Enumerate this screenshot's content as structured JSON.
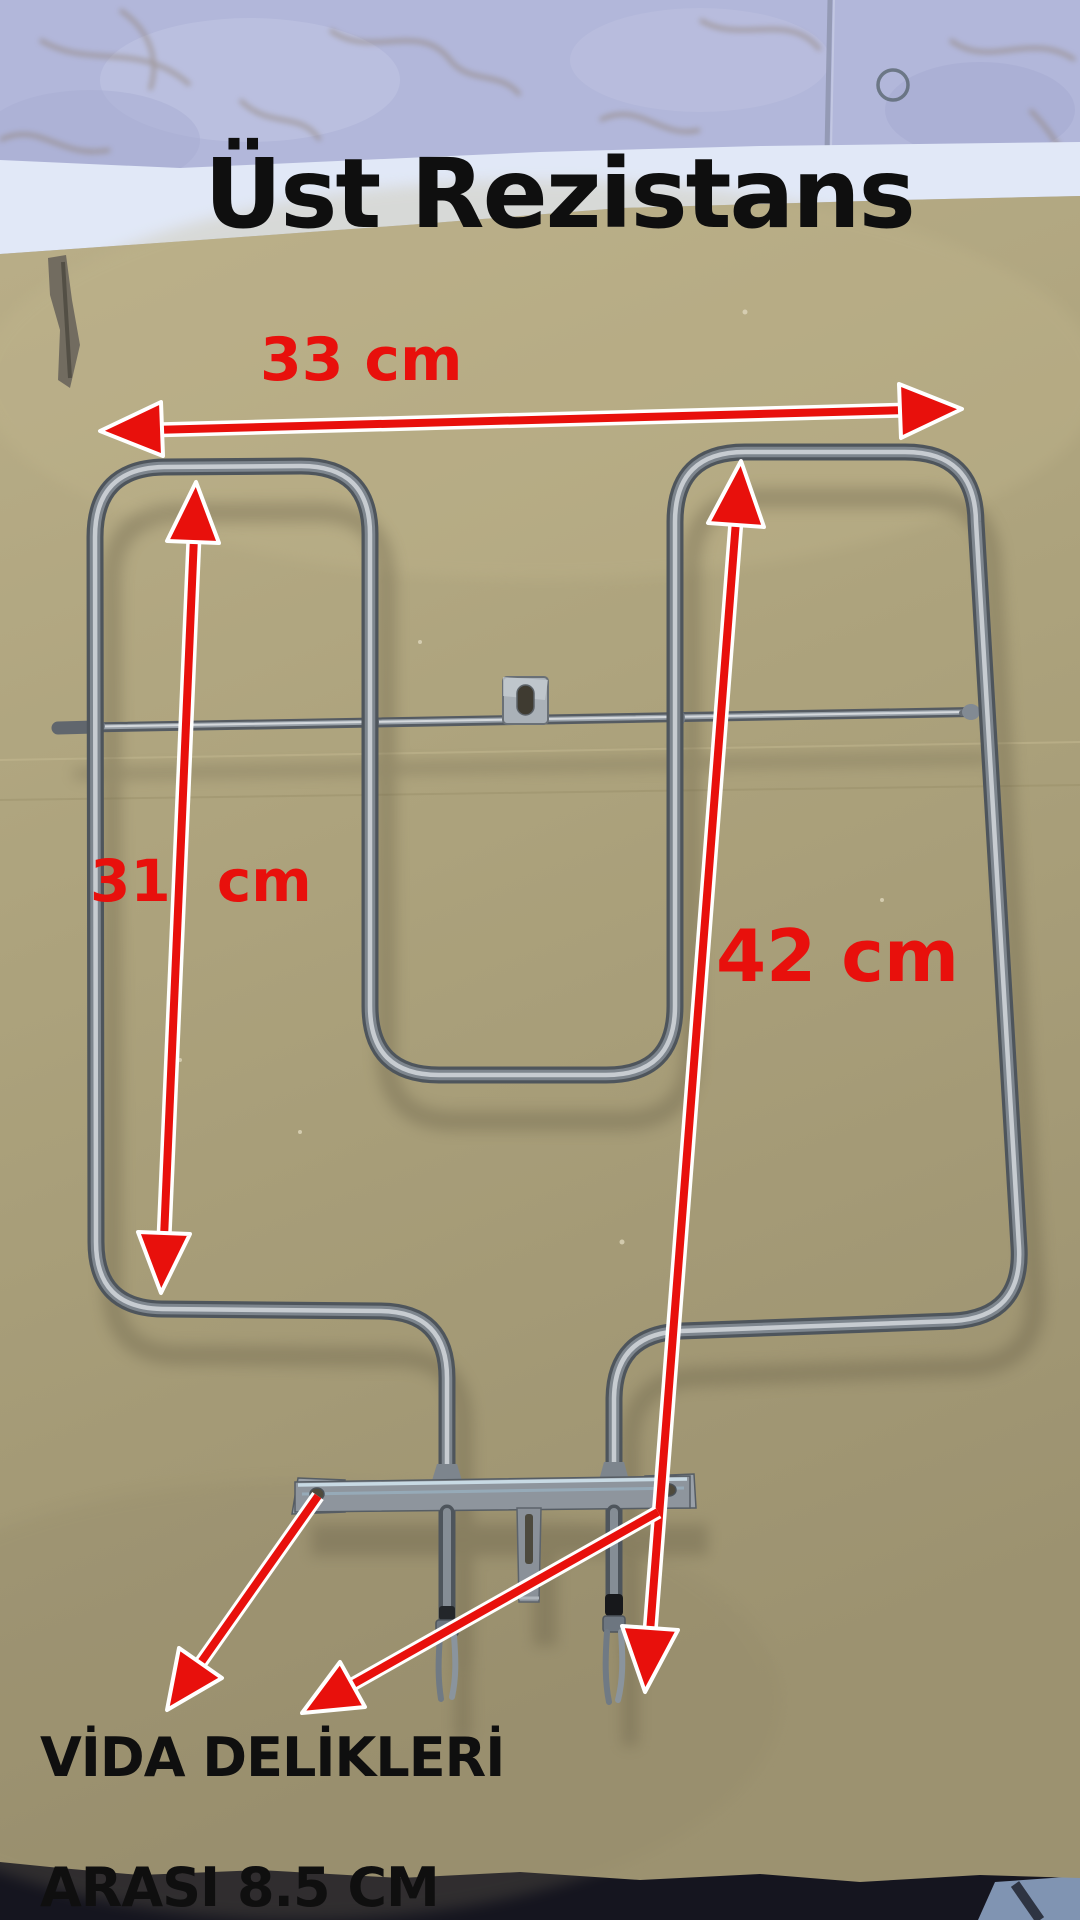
{
  "title": "Üst Rezistans",
  "annotations": {
    "width_label": "33 cm",
    "left_height_label": "31 cm",
    "right_height_label": "42 cm",
    "screw_note_line1": "VİDA DELİKLERİ",
    "screw_note_line2": "ARASI 8.5 CM"
  },
  "icons": {
    "dimension_arrows": "red-double-headed-measure-arrows",
    "pointer_arrows": "red-pointer-arrows-to-screw-holes"
  },
  "colors": {
    "annotation_red": "#e8100c",
    "text_black": "#0f0f0f",
    "cardboard": "#b0a47d",
    "tile_floor": "#b2b7da",
    "torn_edge_white": "#e1e8f7",
    "steel_dark": "#4e555c",
    "steel_mid": "#7e868e",
    "steel_highlight": "#cbd0d5",
    "bottom_shadow_dark": "#15151f",
    "bottom_tile_blue": "#8094b2"
  }
}
